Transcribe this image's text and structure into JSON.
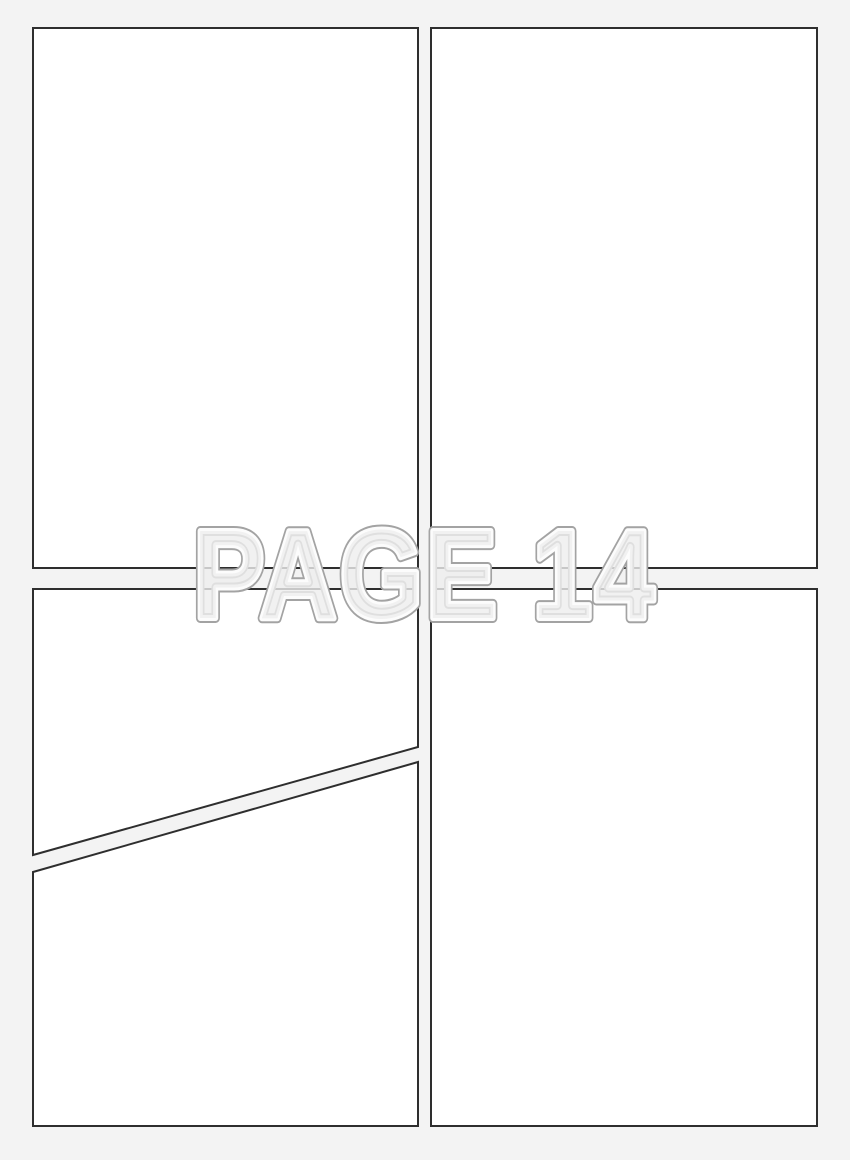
{
  "page": {
    "label": "PAGE 14"
  },
  "colors": {
    "background": "#f3f3f3",
    "panel_fill": "#ffffff",
    "panel_border": "#2e2e2e",
    "label_outline": "#a3a3a3",
    "label_inner_edge": "#fcfcfc",
    "label_fill": "rgba(238,238,238,0.8)"
  },
  "panels": {
    "count": 5
  }
}
